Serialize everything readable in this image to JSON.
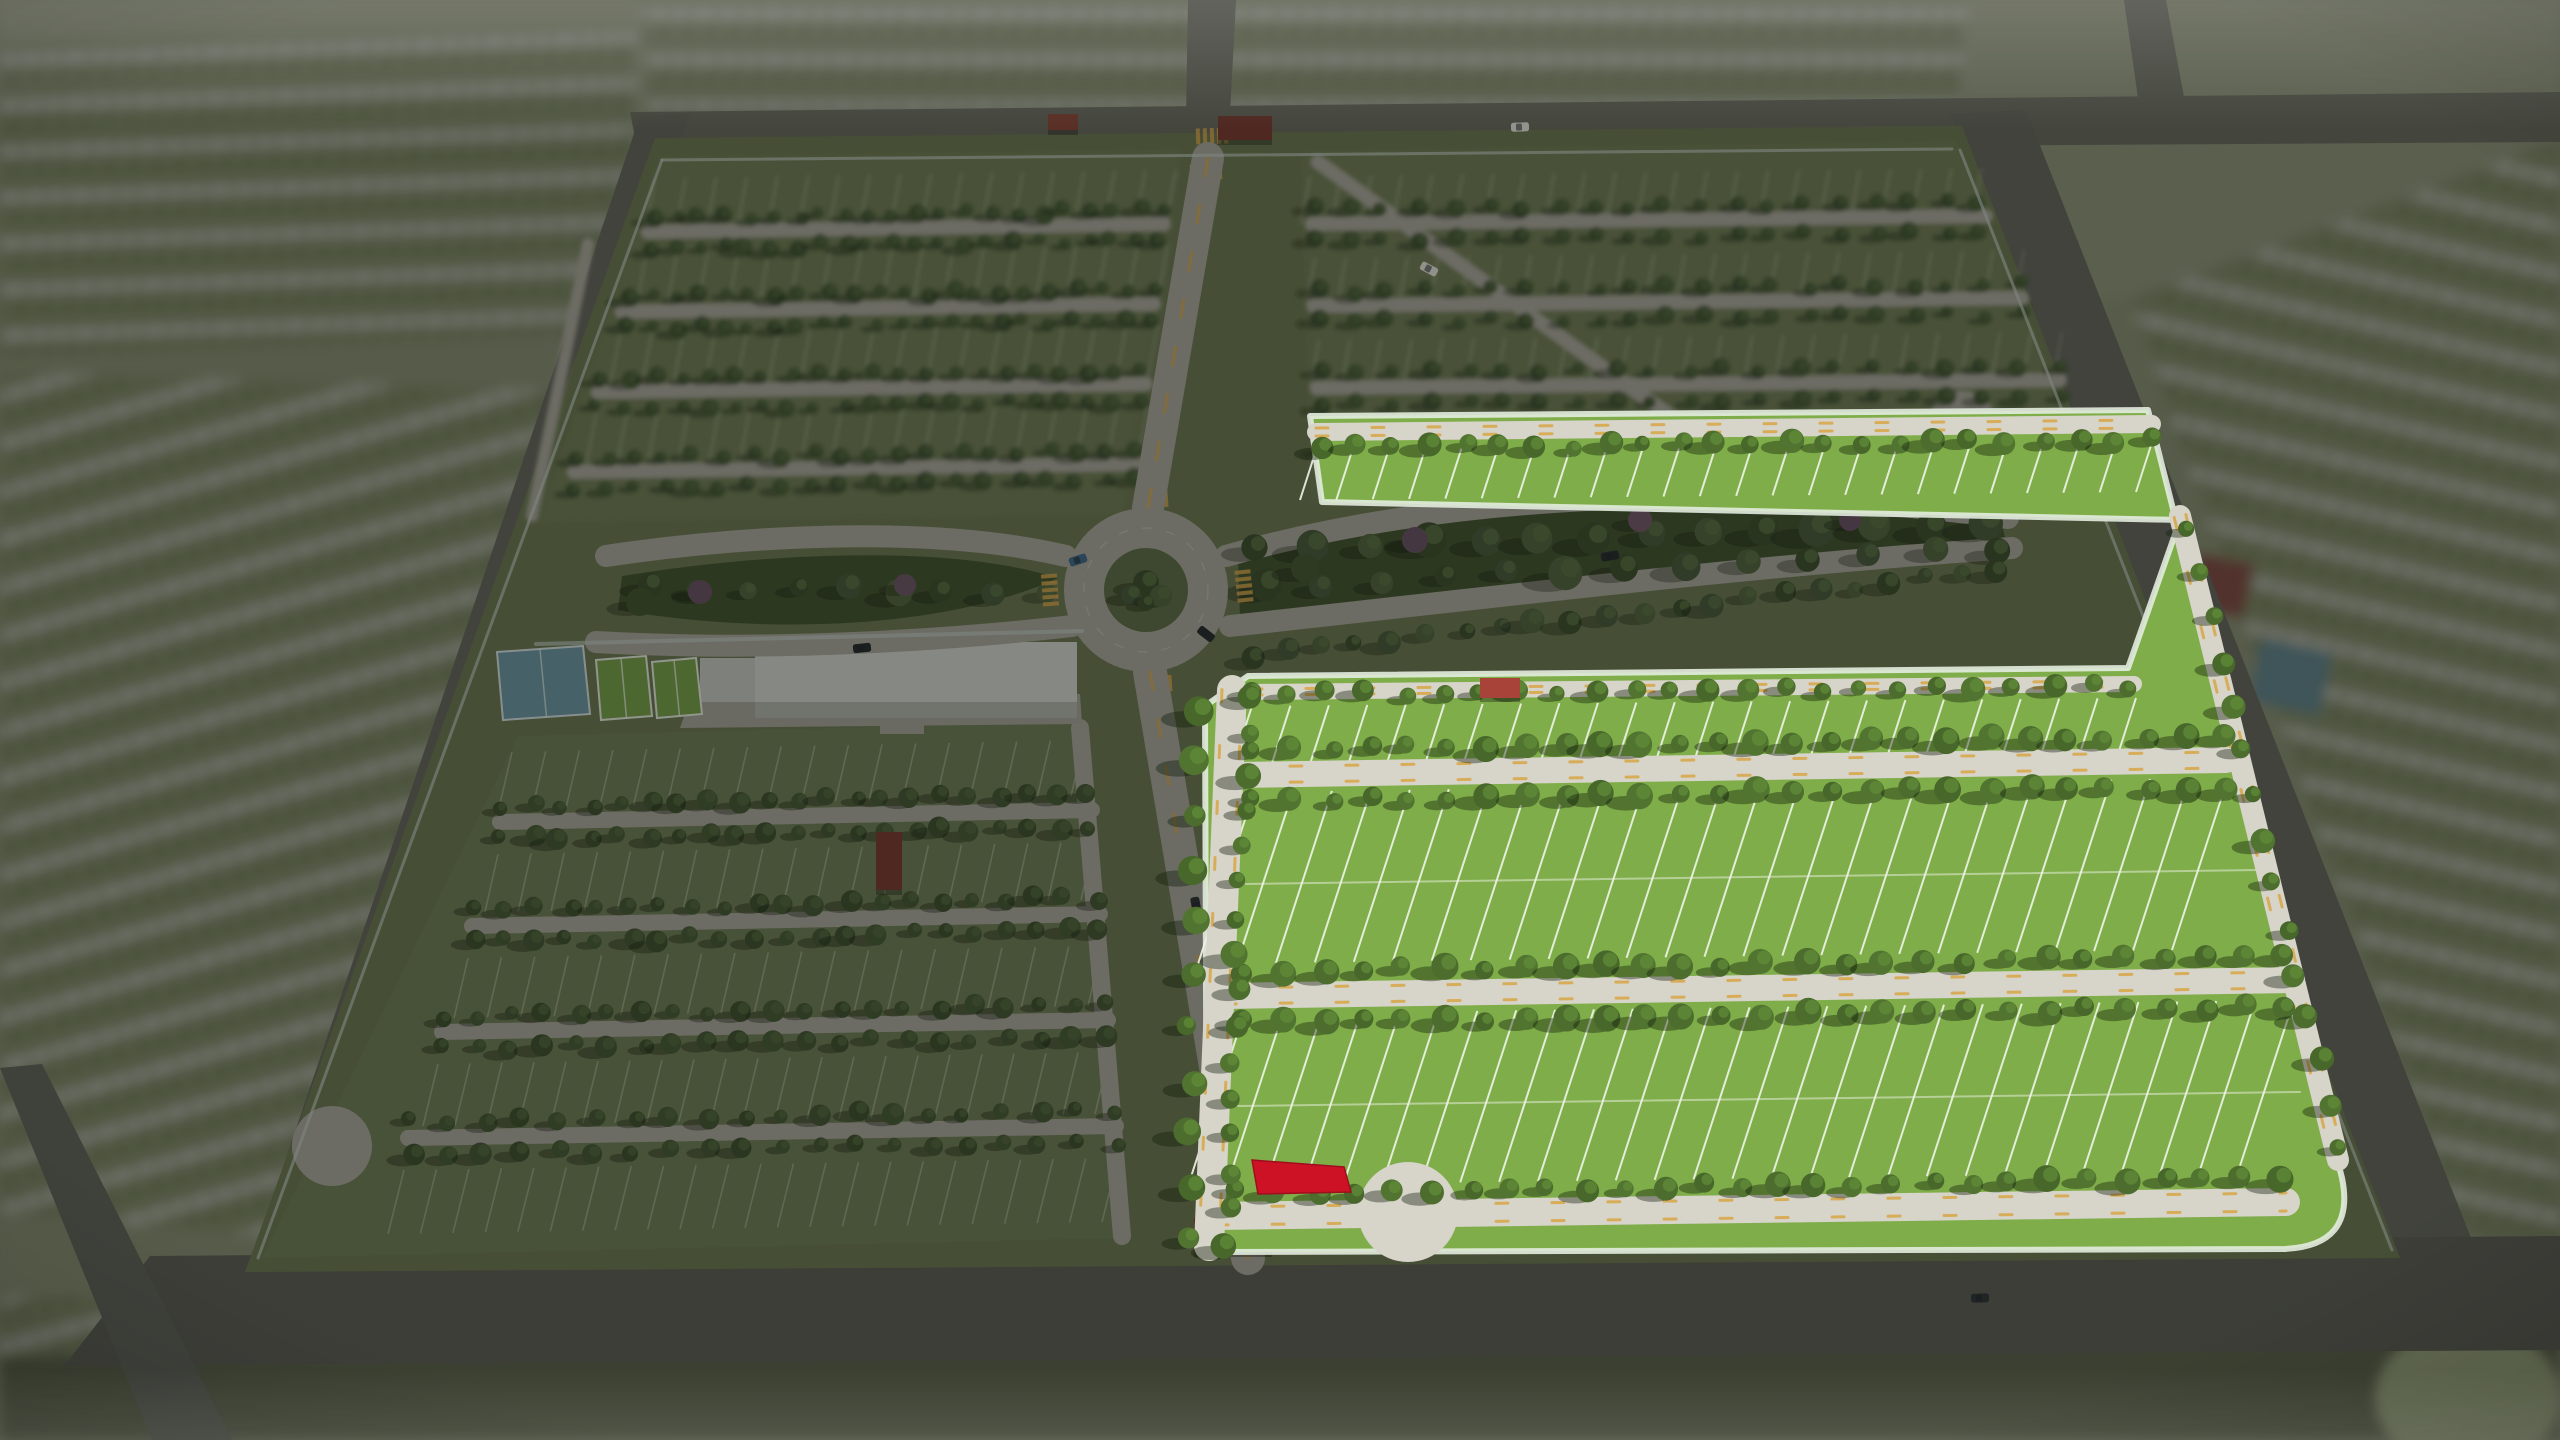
{
  "scene_title": "community-master-plan-aerial-render",
  "colors": {
    "bg_outer": "#878E73",
    "bg_outer_top": "#8E937A",
    "grass_parcel": "#6C7852",
    "grass_quad": "#6F7D55",
    "grass_bright": "#7FAD49",
    "grass_median": "#5E6C46",
    "forest_base": "#42522F",
    "road_dim": "#ABA89E",
    "road_bright": "#D7D4CA",
    "asphalt": "#68695F",
    "asphalt_dark": "#60615A",
    "lot_line_dim": "#C6CCBA",
    "lot_line_bright": "#EDF2E4",
    "crosswalk_yellow": "#D8A84E",
    "wall": "#C5CFCB",
    "building_roof": "#D6D8D2",
    "building_side": "#B3B6AE",
    "building_wing": "#C9CBC5",
    "plaza": "#A7A59B",
    "court_blue": "#6C96A4",
    "court_blue_line": "#D8E2E4",
    "court_green": "#76A049",
    "court_line": "#E8EDE2",
    "selected_lot_red": "#CE1226",
    "selected_lot_edge": "#9E0E1E",
    "gate_roof": "#7A3A30",
    "gate_roof_2": "#8A4336",
    "gate_roof_bright": "#A8433A",
    "dim_overlay": "rgba(15,18,12,0.40)",
    "suburb_base": "#7C8565",
    "suburb_house": "#ACAFA3",
    "suburb_tree": "#55623F",
    "oval_green": "#98A47E"
  },
  "palettes": {
    "bright": {
      "cols": [
        "#48672A",
        "#527431",
        "#4C6D2D"
      ],
      "hi": "#5F8A38",
      "sh": "rgba(18,30,10,0.40)"
    },
    "dim": {
      "cols": [
        "#3E4F30",
        "#475A36",
        "#435532"
      ],
      "hi": "#53683E",
      "sh": "rgba(20,28,14,0.35)"
    },
    "forest": {
      "cols": [
        "#3D4E2E",
        "#46593A",
        "#50633C"
      ],
      "hi": "#5A7044",
      "sh": "rgba(18,26,12,0.32)"
    }
  },
  "outer": {
    "blocks": [
      {
        "points": "640,0 1968,0 1958,112 648,120",
        "rot": 0
      },
      {
        "points": "0,44 636,28 628,332 0,356",
        "rot": -2
      },
      {
        "points": "0,372 598,392 434,1252 0,1212",
        "rot": -16
      },
      {
        "points": "2130,300 2560,140 2560,1245 2466,1242",
        "rot": 13
      },
      {
        "points": "0,1296 404,1306 372,1440 0,1440",
        "rot": -15
      }
    ],
    "roads": [
      {
        "points": "630,112 2560,92 2560,142 638,154",
        "fill": "#68695F"
      },
      {
        "points": "1188,0 1236,0 1230,114 1186,116",
        "fill": "#68695F"
      },
      {
        "points": "2124,0 2166,0 2186,108 2140,112",
        "fill": "#68695F"
      },
      {
        "points": "1950,114 2026,110 2475,1248 2382,1260",
        "fill": "#63645C"
      },
      {
        "points": "640,116 690,114 304,1266 248,1270",
        "fill": "#63645C"
      },
      {
        "points": "150,1256 2560,1236 2560,1350 64,1366",
        "fill": "#5C5D56"
      },
      {
        "points": "0,1068 42,1064 232,1440 152,1440",
        "fill": "#60615A"
      }
    ],
    "extras": [
      {
        "x": 2198,
        "y": 552,
        "w": 58,
        "h": 56,
        "fill": "#7E4A42",
        "name": "neighbor-clubhouse"
      },
      {
        "x": 2262,
        "y": 638,
        "w": 72,
        "h": 64,
        "fill": "#5E828C",
        "name": "neighbor-courts"
      }
    ],
    "oval": {
      "cx": 2468,
      "cy": 1398,
      "rx": 92,
      "ry": 72
    },
    "bottom_grass": {
      "points": "0,1356 2560,1336 2560,1440 0,1440",
      "fill": "#5A604B"
    }
  },
  "parcel": {
    "points": "655,138 1962,126 2400,1258 245,1272"
  },
  "quads": [
    {
      "name": "quadrant-top-left",
      "points": "660,158 1182,150 1122,514 540,522",
      "blur": 2.2,
      "streets": [
        [
          648,
          232,
          1164,
          224,
          14
        ],
        [
          622,
          312,
          1154,
          304,
          14
        ],
        [
          598,
          392,
          1146,
          384,
          14
        ],
        [
          574,
          472,
          1138,
          464,
          14
        ],
        [
          588,
          244,
          532,
          516,
          12
        ]
      ],
      "treeRows": [
        [
          652,
          218,
          1162,
          210,
          22,
          8
        ],
        [
          650,
          248,
          1160,
          240,
          22,
          8
        ],
        [
          626,
          298,
          1152,
          290,
          22,
          8
        ],
        [
          624,
          328,
          1150,
          320,
          22,
          8
        ],
        [
          600,
          378,
          1144,
          370,
          21,
          8
        ],
        [
          598,
          408,
          1142,
          400,
          21,
          8
        ],
        [
          576,
          458,
          1136,
          450,
          20,
          8
        ],
        [
          574,
          488,
          1134,
          480,
          20,
          8
        ]
      ],
      "bands": [
        [
          655,
          178,
          1176,
          170,
          30,
          -9,
          48
        ],
        [
          646,
          254,
          1168,
          246,
          30,
          -9,
          50
        ],
        [
          620,
          334,
          1158,
          326,
          30,
          -10,
          52
        ],
        [
          596,
          414,
          1148,
          406,
          30,
          -10,
          52
        ]
      ],
      "culdesacs": []
    },
    {
      "name": "quadrant-top-right",
      "points": "1302,152 1956,142 2098,488 1312,502",
      "blur": 2.2,
      "streets": [
        [
          1312,
          224,
          1986,
          216,
          14
        ],
        [
          1314,
          306,
          2022,
          298,
          14
        ],
        [
          1317,
          388,
          2060,
          380,
          14
        ],
        [
          1318,
          162,
          1745,
          470,
          14
        ]
      ],
      "treeRows": [
        [
          1312,
          210,
          1980,
          202,
          20,
          8
        ],
        [
          1312,
          240,
          1982,
          232,
          20,
          8
        ],
        [
          1316,
          292,
          2018,
          284,
          21,
          8
        ],
        [
          1316,
          322,
          2020,
          314,
          21,
          8
        ],
        [
          1320,
          374,
          2056,
          366,
          21,
          8
        ],
        [
          1320,
          404,
          2058,
          396,
          21,
          8
        ],
        [
          1322,
          452,
          2080,
          446,
          20,
          8
        ]
      ],
      "bands": [
        [
          1310,
          176,
          1982,
          168,
          30,
          -9,
          48
        ],
        [
          1315,
          258,
          2024,
          250,
          30,
          -9,
          50
        ],
        [
          1319,
          340,
          2062,
          332,
          30,
          -9,
          50
        ],
        [
          1322,
          420,
          2094,
          414,
          30,
          -9,
          50
        ]
      ],
      "culdesacs": [
        [
          1962,
          425,
          34
        ]
      ]
    },
    {
      "name": "quadrant-bottom-left",
      "points": "518,736 1076,722 1120,1238 262,1258",
      "blur": 0,
      "streets": [
        [
          500,
          822,
          1092,
          810,
          16
        ],
        [
          472,
          926,
          1100,
          914,
          16
        ],
        [
          442,
          1032,
          1108,
          1020,
          16
        ],
        [
          408,
          1138,
          1116,
          1126,
          16
        ],
        [
          1080,
          728,
          1122,
          1236,
          18
        ]
      ],
      "treeRows": [
        [
          504,
          806,
          1088,
          794,
          21,
          9
        ],
        [
          502,
          838,
          1090,
          826,
          21,
          9
        ],
        [
          476,
          910,
          1096,
          898,
          21,
          9
        ],
        [
          474,
          942,
          1098,
          930,
          21,
          9
        ],
        [
          446,
          1016,
          1104,
          1004,
          21,
          9
        ],
        [
          444,
          1048,
          1106,
          1036,
          21,
          9
        ],
        [
          412,
          1122,
          1112,
          1110,
          20,
          9
        ],
        [
          410,
          1154,
          1114,
          1142,
          20,
          9
        ]
      ],
      "bands": [
        [
          512,
          752,
          1084,
          740,
          32,
          -13,
          56
        ],
        [
          498,
          854,
          1094,
          842,
          32,
          -13,
          58
        ],
        [
          468,
          958,
          1102,
          946,
          32,
          -14,
          60
        ],
        [
          438,
          1064,
          1110,
          1052,
          32,
          -15,
          62
        ],
        [
          404,
          1170,
          1118,
          1158,
          32,
          -16,
          64
        ]
      ],
      "culdesacs": [
        [
          332,
          1146,
          40
        ]
      ]
    }
  ],
  "amenity": {
    "plaza": {
      "points": "690,700 1080,694 1082,724 680,728"
    },
    "building": [
      {
        "x": 700,
        "y": 658,
        "w": 58,
        "h": 44,
        "part": "wing"
      },
      {
        "x": 755,
        "y": 642,
        "w": 322,
        "h": 60,
        "part": "roof"
      },
      {
        "x": 755,
        "y": 702,
        "w": 322,
        "h": 16,
        "part": "side"
      },
      {
        "x": 880,
        "y": 718,
        "w": 44,
        "h": 16,
        "part": "path"
      }
    ],
    "courts": [
      {
        "points": "497,652 583,646 590,714 503,720",
        "fill": "court_blue",
        "stroke": "court_blue_line",
        "name": "basketball-court"
      },
      {
        "points": "596,660 646,656 652,716 601,720",
        "fill": "court_green",
        "stroke": "court_line",
        "name": "tennis-court-1"
      },
      {
        "points": "652,662 696,658 702,714 657,718",
        "fill": "court_green",
        "stroke": "court_line",
        "name": "tennis-court-2"
      }
    ]
  },
  "boulevards": {
    "roads": [
      "M606,556 C740,536 930,524 1066,556",
      "M596,642 C770,652 950,640 1072,626",
      "M1226,556 C1430,498 1710,478 2008,518",
      "M1230,626 C1470,600 1745,566 2012,548"
    ],
    "medians": [
      {
        "d": "M622,576 C770,552 950,544 1058,578 C950,628 770,636 618,610 Z"
      },
      {
        "d": "M1238,560 C1430,508 1705,486 2002,524 L2006,542 C1745,556 1475,590 1240,618 Z"
      }
    ],
    "treeRows": [
      [
        648,
        586,
        1044,
        592,
        9,
        11
      ],
      [
        1258,
        546,
        1990,
        524,
        14,
        16
      ],
      [
        1262,
        586,
        1995,
        548,
        13,
        14
      ],
      [
        1250,
        656,
        2000,
        570,
        22,
        10
      ]
    ],
    "clusters": [
      [
        700,
        592,
        12,
        "#6A5164"
      ],
      [
        905,
        585,
        11,
        "#6F5568"
      ],
      [
        1415,
        540,
        13,
        "#6A5164"
      ],
      [
        1640,
        520,
        12,
        "#73576B"
      ],
      [
        1850,
        520,
        11,
        "#6A5164"
      ],
      [
        1305,
        568,
        14,
        "#445831"
      ],
      [
        640,
        602,
        14,
        "#41532F"
      ]
    ]
  },
  "roundabout": {
    "cx": 1146,
    "cy": 590,
    "rOuter": 82,
    "rLane": 62,
    "rInner": 42,
    "palms": [
      [
        1146,
        583,
        13
      ],
      [
        1131,
        595,
        10
      ],
      [
        1161,
        596,
        11
      ],
      [
        1146,
        603,
        8
      ]
    ],
    "crosswalks": [
      [
        1152,
        500,
        -4
      ],
      [
        1156,
        684,
        -4
      ],
      [
        1050,
        590,
        86
      ],
      [
        1244,
        586,
        84
      ],
      [
        1206,
        172,
        -3
      ],
      [
        1240,
        1236,
        -3
      ],
      [
        1212,
        136,
        -2
      ]
    ]
  },
  "mainRoads": [
    [
      1208,
      158,
      1148,
      508,
      32
    ],
    [
      1150,
      672,
      1248,
      1258,
      34
    ]
  ],
  "walls": [
    [
      662,
      160,
      1952,
      149,
      3
    ],
    [
      662,
      160,
      258,
      1258,
      3
    ],
    [
      1960,
      150,
      2392,
      1250,
      3
    ],
    [
      536,
      644,
      1082,
      631,
      4
    ]
  ],
  "structures": [
    {
      "x": 1218,
      "y": 116,
      "w": 54,
      "h": 24,
      "fill": "gate_roof",
      "name": "north-entry-gate"
    },
    {
      "x": 1048,
      "y": 114,
      "w": 30,
      "h": 16,
      "fill": "gate_roof_2",
      "name": "north-entry-gate-2"
    },
    {
      "x": 1194,
      "y": 1218,
      "w": 78,
      "h": 34,
      "fill": "gate_roof_2",
      "name": "south-entry-gate"
    },
    {
      "x": 876,
      "y": 832,
      "w": 26,
      "h": 58,
      "fill": "gate_roof",
      "name": "west-entry-gate"
    }
  ],
  "cars": [
    [
      1520,
      127,
      -2,
      "#E9E9E3"
    ],
    [
      1429,
      269,
      28,
      "#E6E6E0"
    ],
    [
      1078,
      560,
      -18,
      "#3E688C"
    ],
    [
      1206,
      634,
      38,
      "#24282D"
    ],
    [
      862,
      648,
      -6,
      "#24282D"
    ],
    [
      1196,
      906,
      80,
      "#2A2F35"
    ],
    [
      1610,
      556,
      -10,
      "#24282D"
    ],
    [
      2214,
      830,
      70,
      "#24282D"
    ],
    [
      1980,
      1298,
      -2,
      "#2E3237"
    ]
  ],
  "bright": {
    "base_path": "M1310,416 L2148,410 L2342,1178 Q2356,1246 2284,1249 L1207,1252 L1205,706 L1248,676 L2128,668 L2180,520 L1322,502 Z",
    "curb": "#E3ECDF",
    "streets": [
      [
        1316,
        432,
        2152,
        424,
        18
      ],
      [
        1250,
        692,
        2134,
        684,
        16
      ],
      [
        1234,
        775,
        2226,
        760,
        26
      ],
      [
        1224,
        996,
        2292,
        980,
        26
      ],
      [
        1216,
        1216,
        2286,
        1202,
        28
      ],
      [
        1232,
        690,
        1209,
        1246,
        30
      ],
      [
        2180,
        516,
        2338,
        1160,
        22
      ]
    ],
    "treeRows": [
      [
        1320,
        448,
        2150,
        440,
        24,
        10
      ],
      [
        1252,
        694,
        2130,
        686,
        24,
        10
      ],
      [
        1254,
        750,
        2222,
        736,
        26,
        11
      ],
      [
        1254,
        800,
        2224,
        786,
        26,
        11
      ],
      [
        1242,
        972,
        2286,
        956,
        27,
        11
      ],
      [
        1242,
        1022,
        2288,
        1006,
        27,
        11
      ],
      [
        1238,
        1192,
        2280,
        1178,
        28,
        11
      ],
      [
        1248,
        700,
        1226,
        1244,
        16,
        11
      ],
      [
        1194,
        710,
        1188,
        1240,
        11,
        12
      ],
      [
        2190,
        530,
        2340,
        1150,
        15,
        10
      ]
    ],
    "bands": [
      [
        1318,
        444,
        2154,
        436,
        36,
        -18,
        56
      ],
      [
        1252,
        706,
        2136,
        698,
        38,
        -18,
        56
      ],
      [
        1254,
        792,
        2228,
        778,
        38,
        -56,
        172
      ],
      [
        1244,
        1014,
        2294,
        1000,
        38,
        -56,
        172
      ]
    ],
    "midlines": [
      [
        1246,
        884,
        2258,
        870
      ],
      [
        1238,
        1106,
        2300,
        1092
      ]
    ],
    "culdesac": {
      "cx": 1408,
      "cy": 1212,
      "r": 50
    },
    "gatehouse": {
      "x": 1480,
      "y": 678,
      "w": 40,
      "h": 20
    },
    "selected_lot": {
      "points": "1252,1160 1344,1167 1351,1192 1258,1194"
    }
  }
}
